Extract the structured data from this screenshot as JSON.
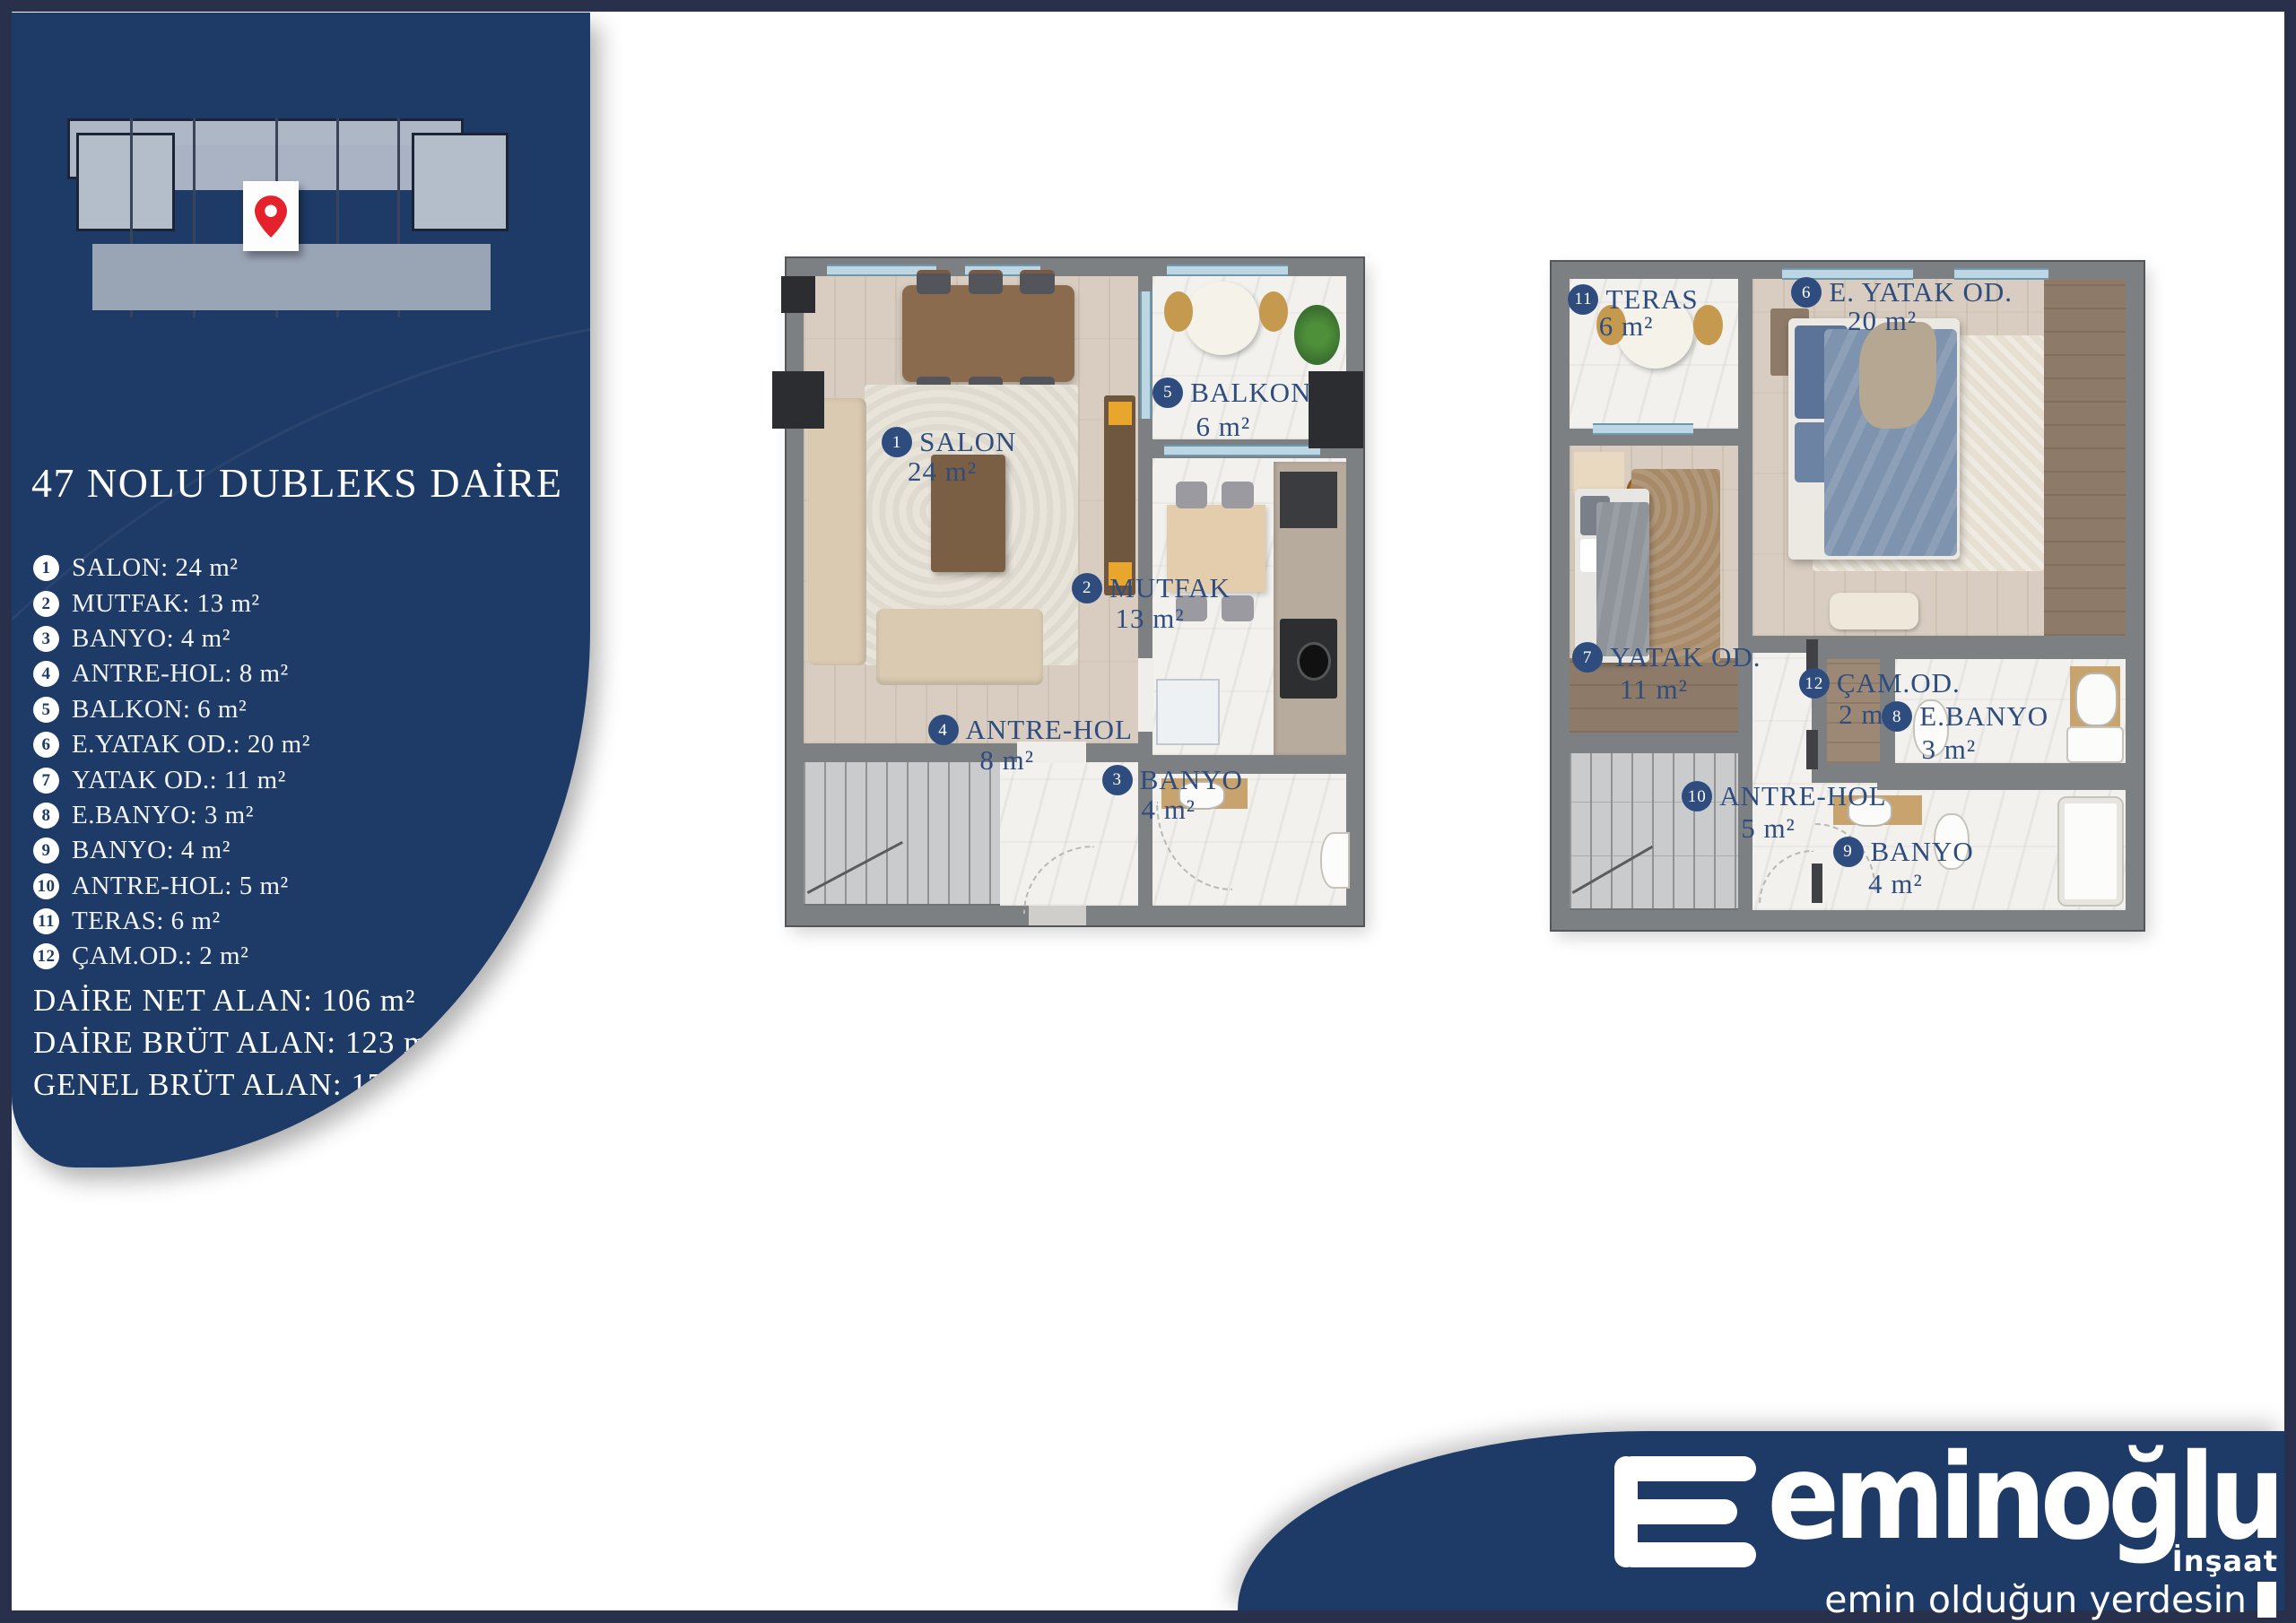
{
  "colors": {
    "navy": "#1e3a66",
    "frame": "#28304b",
    "label_navy": "#2e4d7e",
    "pin_red": "#e3222b",
    "wall_gray": "#7d8083"
  },
  "sidebar": {
    "title": "47 NOLU DUBLEKS DAİRE",
    "items": [
      {
        "num": "1",
        "text": "SALON: 24 m²"
      },
      {
        "num": "2",
        "text": "MUTFAK: 13 m²"
      },
      {
        "num": "3",
        "text": "BANYO: 4 m²"
      },
      {
        "num": "4",
        "text": "ANTRE-HOL: 8 m²"
      },
      {
        "num": "5",
        "text": "BALKON: 6 m²"
      },
      {
        "num": "6",
        "text": "E.YATAK OD.: 20 m²"
      },
      {
        "num": "7",
        "text": "YATAK OD.: 11 m²"
      },
      {
        "num": "8",
        "text": "E.BANYO: 3 m²"
      },
      {
        "num": "9",
        "text": "BANYO: 4 m²"
      },
      {
        "num": "10",
        "text": "ANTRE-HOL: 5 m²"
      },
      {
        "num": "11",
        "text": "TERAS: 6 m²"
      },
      {
        "num": "12",
        "text": "ÇAM.OD.: 2 m²"
      }
    ],
    "totals": [
      {
        "text": "DAİRE NET ALAN: 106 m²"
      },
      {
        "text": "DAİRE BRÜT ALAN: 123 m²"
      },
      {
        "text": "GENEL BRÜT ALAN: 174 m²"
      }
    ]
  },
  "plans": {
    "floor1": {
      "rooms": [
        {
          "num": "1",
          "name": "SALON",
          "area": "24 m²"
        },
        {
          "num": "5",
          "name": "BALKON",
          "area": "6 m²"
        },
        {
          "num": "2",
          "name": "MUTFAK",
          "area": "13 m²"
        },
        {
          "num": "4",
          "name": "ANTRE-HOL",
          "area": "8 m²"
        },
        {
          "num": "3",
          "name": "BANYO",
          "area": "4 m²"
        }
      ]
    },
    "floor2": {
      "rooms": [
        {
          "num": "11",
          "name": "TERAS",
          "area": "6 m²"
        },
        {
          "num": "6",
          "name": "E. YATAK OD.",
          "area": "20 m²"
        },
        {
          "num": "7",
          "name": "YATAK OD.",
          "area": "11 m²"
        },
        {
          "num": "12",
          "name": "ÇAM.OD.",
          "area": "2 m²"
        },
        {
          "num": "8",
          "name": "E.BANYO",
          "area": "3 m²"
        },
        {
          "num": "10",
          "name": "ANTRE-HOL",
          "area": "5 m²"
        },
        {
          "num": "9",
          "name": "BANYO",
          "area": "4 m²"
        }
      ]
    }
  },
  "footer": {
    "brand": "eminoğlu",
    "division": "İnşaat",
    "tagline": "emin olduğun yerdesin"
  }
}
